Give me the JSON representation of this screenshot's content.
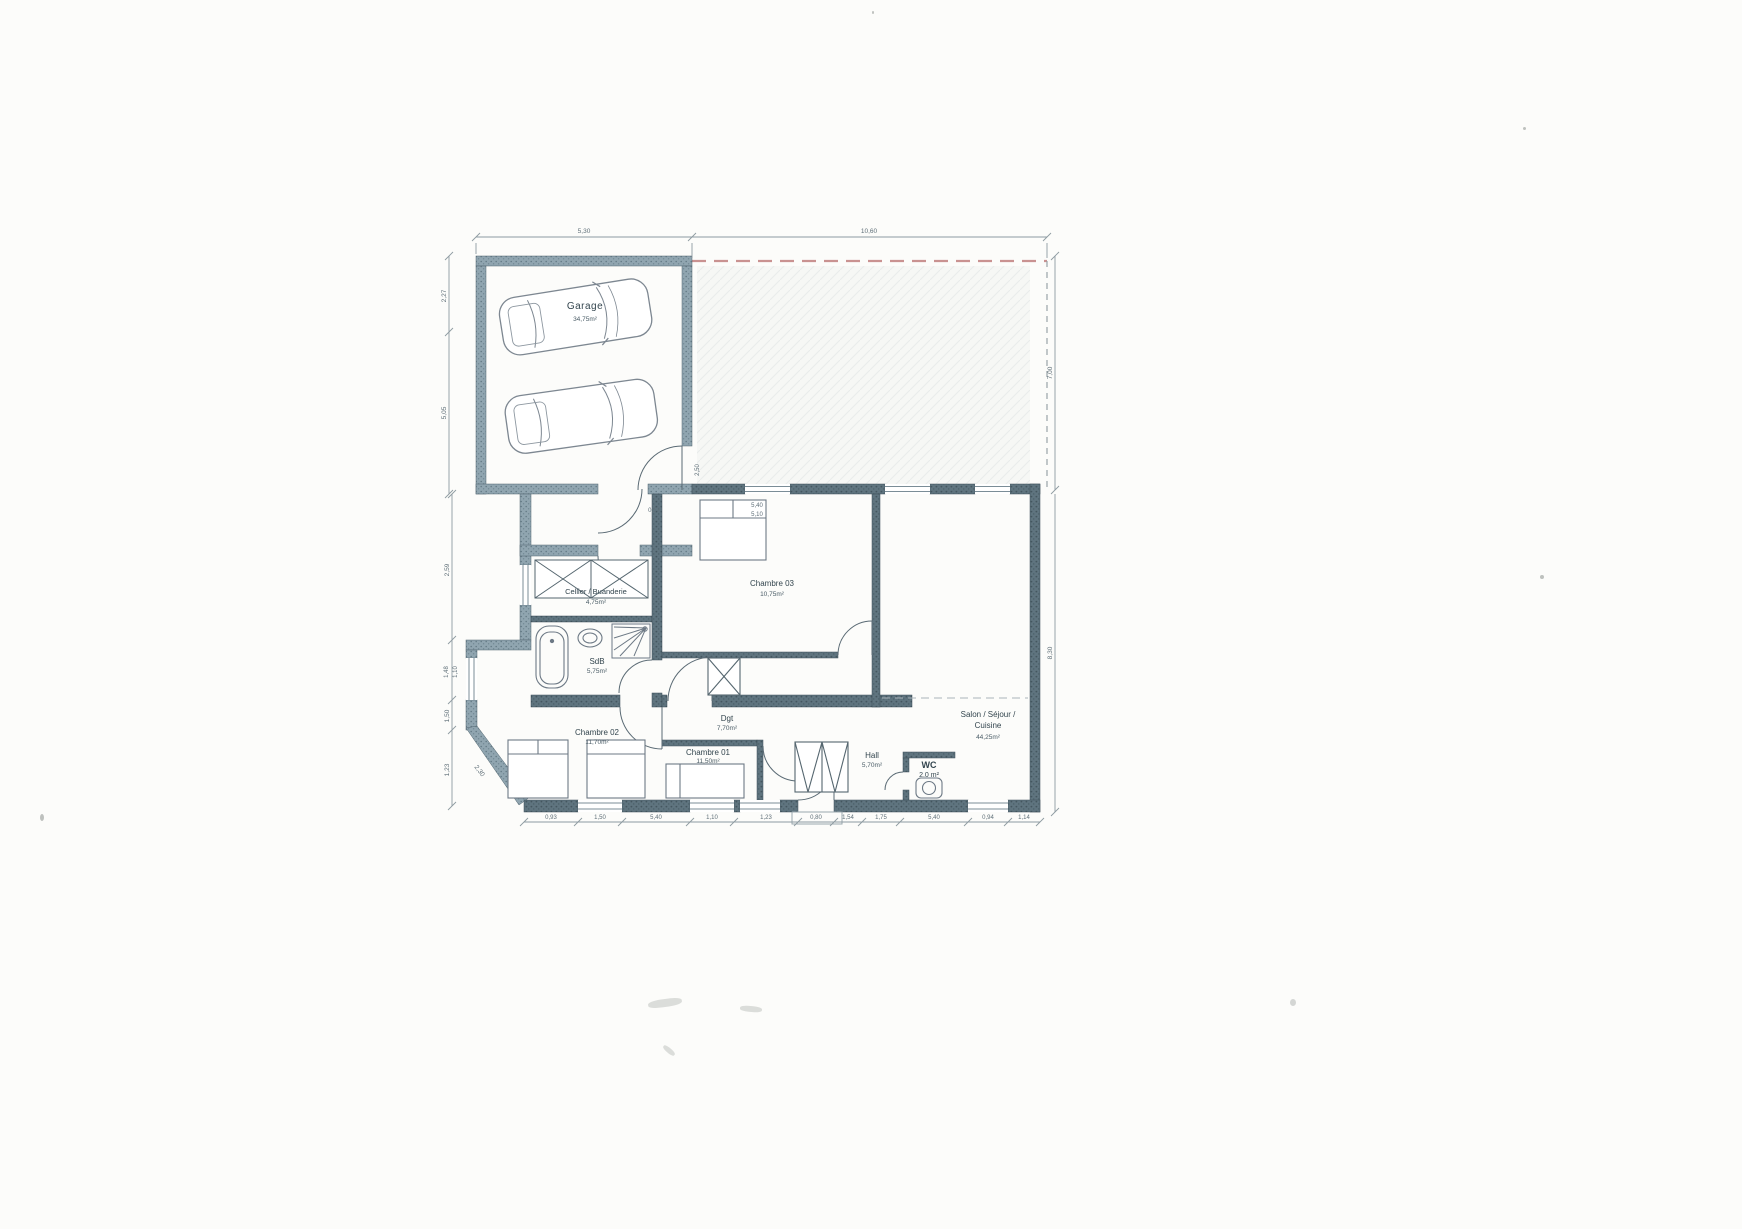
{
  "plan": {
    "rooms": {
      "garage": {
        "name": "Garage",
        "area": "34,75m²"
      },
      "cellier": {
        "name": "Cellier / Buanderie",
        "area": "4,75m²"
      },
      "chambre03": {
        "name": "Chambre 03",
        "area": "10,75m²"
      },
      "sdb": {
        "name": "SdB",
        "area": "5,75m²"
      },
      "chambre02": {
        "name": "Chambre 02",
        "area": "11,70m²"
      },
      "dgt": {
        "name": "Dgt",
        "area": "7,70m²"
      },
      "chambre01": {
        "name": "Chambre 01",
        "area": "11,50m²"
      },
      "hall": {
        "name": "Hall",
        "area": "5,70m²"
      },
      "wc": {
        "name": "WC",
        "area": "2.0 m²"
      },
      "salon": {
        "line1": "Salon / Séjour /",
        "line2": "Cuisine",
        "area": "44,25m²"
      }
    },
    "dims": {
      "top": [
        "5,30",
        "10,60"
      ],
      "left": [
        "2,27",
        "5,05",
        "2,59",
        "1,48",
        "1,10",
        "1,50",
        "1,23",
        "2,30"
      ],
      "right": [
        "7,00",
        "8,30"
      ],
      "bottom": [
        "0,93",
        "1,50",
        "5,40",
        "1,10",
        "1,23",
        "0,80",
        "1,54",
        "1,75",
        "5,40",
        "0,94",
        "1,14"
      ],
      "interior": [
        "0,57",
        "5,40",
        "5,10",
        "2,50"
      ]
    },
    "colors": {
      "wall_dark": "#5f747f",
      "wall_light": "#90a5b0",
      "terrace_dash": "#b96f6f",
      "dim_text": "#5f6f78",
      "label_text": "#33454e",
      "paper": "#fcfcfa"
    }
  }
}
